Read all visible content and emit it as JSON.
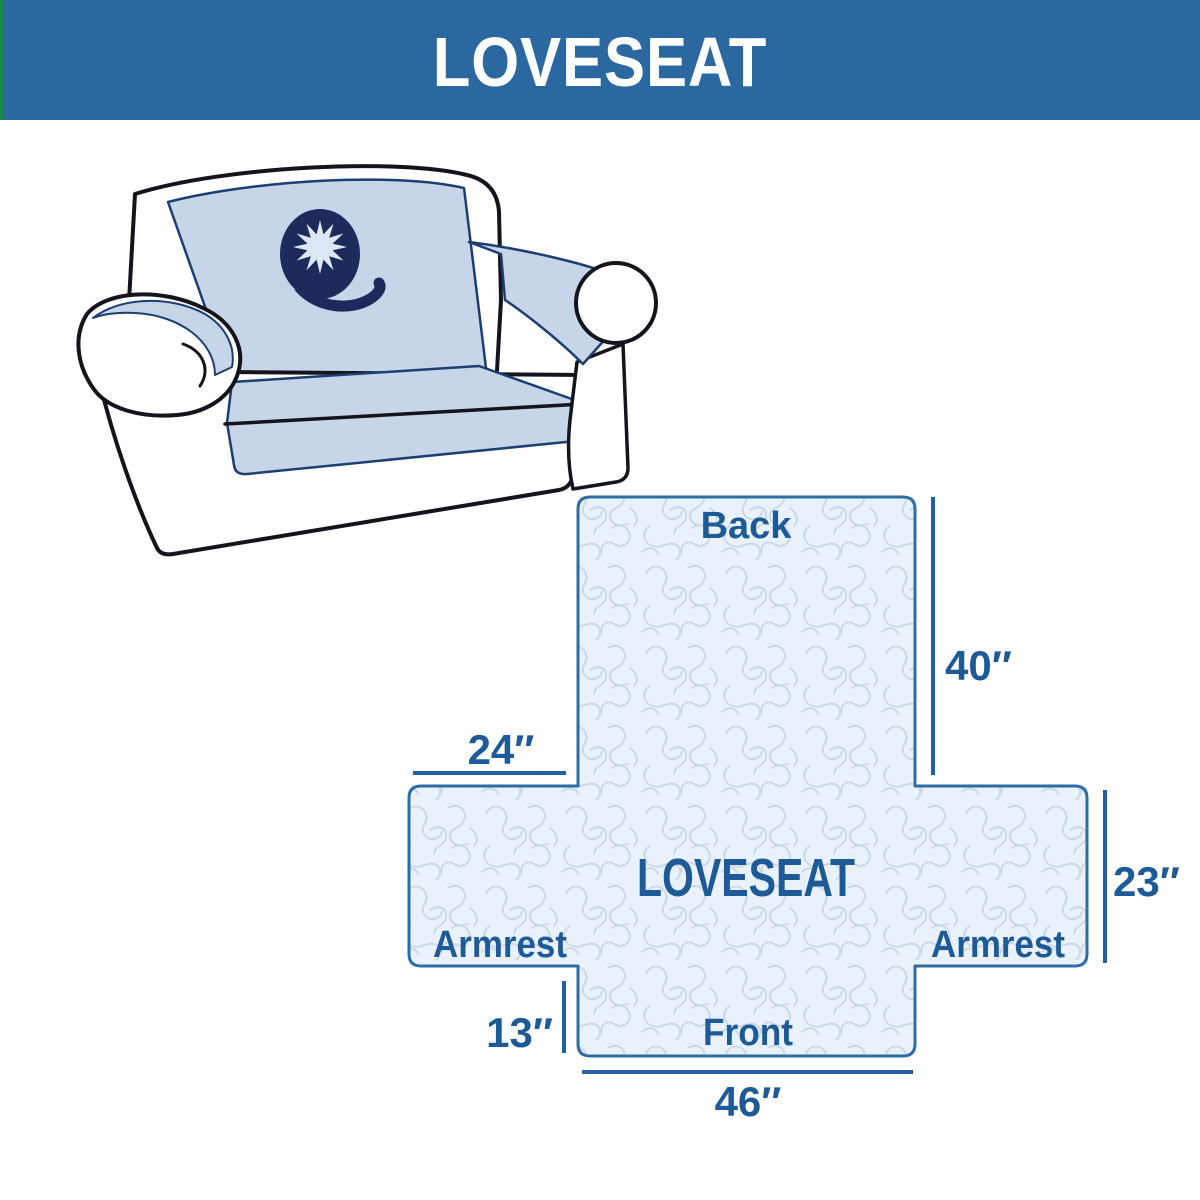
{
  "header": {
    "title": "LOVESEAT"
  },
  "sofa_illustration": {
    "description": "loveseat sofa with quilted furniture cover and Q star logo"
  },
  "diagram": {
    "center_label": "LOVESEAT",
    "back_label": "Back",
    "front_label": "Front",
    "armrest_left_label": "Armrest",
    "armrest_right_label": "Armrest",
    "dim_back_height": "40″",
    "dim_back_width": "24″",
    "dim_armrest_height": "23″",
    "dim_front_drop": "13″",
    "dim_front_width": "46″"
  },
  "colors": {
    "banner_bg": "#2b689f",
    "banner_accent_green": "#15894a",
    "banner_text": "#ffffff",
    "diagram_fill": "#e9f1fa",
    "diagram_pattern": "#c9d6e4",
    "diagram_outline": "#2e6da4",
    "dimension_line": "#2360a2",
    "label_text": "#1e5b96",
    "cover_blue": "#c6d5e8",
    "cover_outline": "#1c3e70",
    "sofa_outline": "#14141c",
    "logo_navy": "#1e2a5c",
    "logo_star": "#dde8f4"
  }
}
